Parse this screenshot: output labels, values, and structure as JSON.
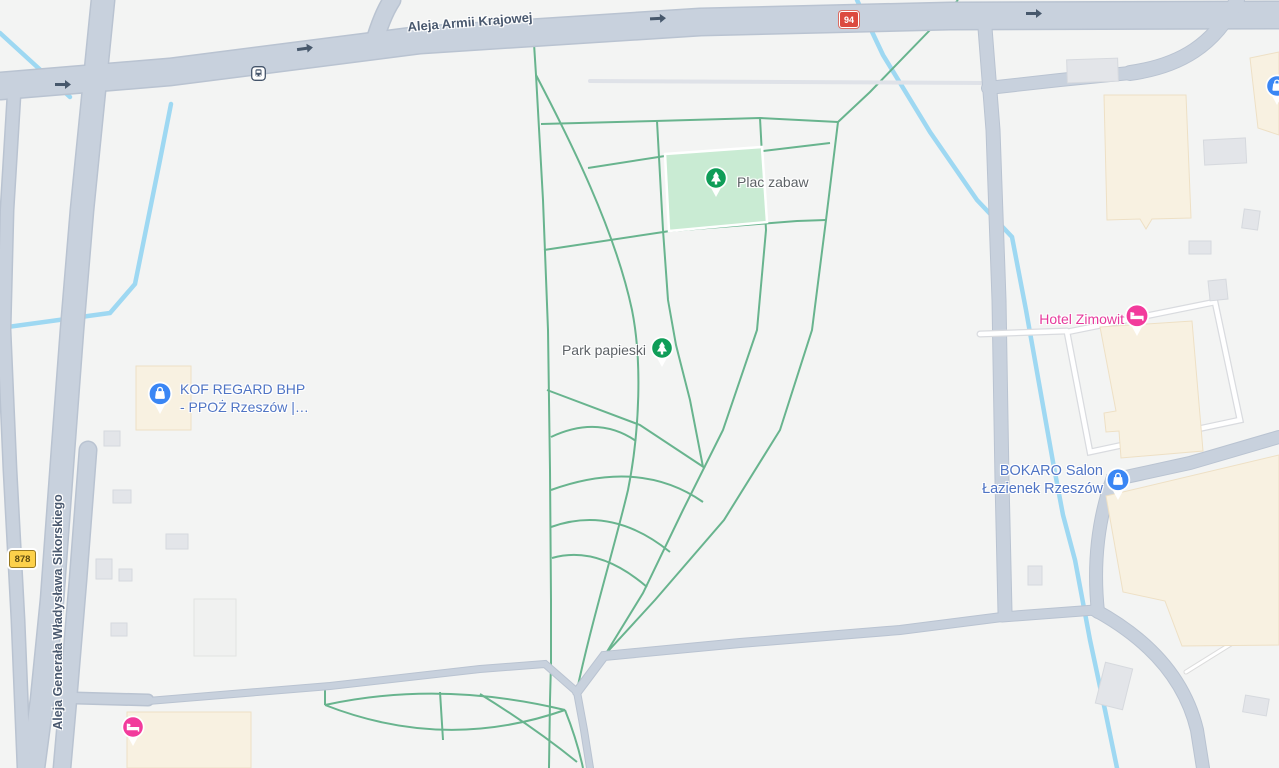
{
  "app": {
    "type": "map-view",
    "area": "Rzeszów, Poland"
  },
  "colors": {
    "background": "#f3f4f3",
    "road_fill": "#c8d1dd",
    "road_casing": "#b9c3d1",
    "water": "#9ed8f2",
    "park_path": "#68b48e",
    "playground_fill": "#c9ebd3",
    "poi_shopping": "#4f74c4",
    "poi_hotel": "#e6399b",
    "poi_park_pin": "#0f9d58",
    "poi_shop_pin": "#3a86f4",
    "poi_hotel_pin": "#f23b9c"
  },
  "roads": {
    "labels": [
      {
        "name": "Aleja Armii Krajowej"
      },
      {
        "name": "Aleja Generała Władysława Sikorskiego"
      }
    ],
    "shields": [
      {
        "number": "94"
      },
      {
        "number": "878"
      }
    ]
  },
  "park": {
    "name": "Park papieski",
    "playground": "Plac zabaw"
  },
  "pois": [
    {
      "line1": "KOF REGARD BHP",
      "line2": "- PPOŻ Rzeszów |…",
      "category": "shopping"
    },
    {
      "line1": "Hotel Zimowit",
      "category": "hotel"
    },
    {
      "line1": "BOKARO Salon",
      "line2": "Łazienek Rzeszów",
      "category": "shopping"
    },
    {
      "category": "hotel",
      "label": ""
    },
    {
      "category": "shopping",
      "label": ""
    }
  ],
  "transit": {
    "bus_stop_count": 1
  }
}
